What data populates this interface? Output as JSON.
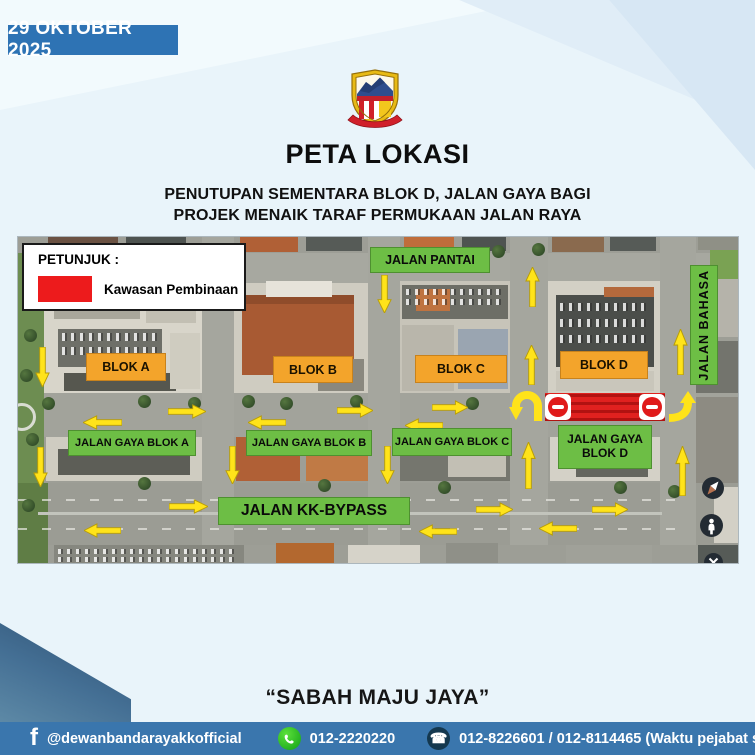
{
  "banner": {
    "date": "29 OKTOBER 2025",
    "bg": "#2e73b4"
  },
  "title": "PETA LOKASI",
  "subtitle": {
    "line1": "PENUTUPAN SEMENTARA BLOK D, JALAN GAYA BAGI",
    "line2": "PROJEK MENAIK TARAF PERMUKAAN JALAN RAYA"
  },
  "legend": {
    "heading": "PETUNJUK :",
    "label": "Kawasan Pembinaan",
    "swatch_color": "#ed1b1c"
  },
  "map": {
    "road_label_color": "#6dbe45",
    "block_label_color": "#f3a42b",
    "arrow_color": "#ffe31a",
    "construction_color": "#e0211f",
    "road_labels": [
      {
        "text": "JALAN PANTAI",
        "x": 352,
        "y": 10,
        "w": 120,
        "h": 26,
        "fs": 12.5
      },
      {
        "text": "JALAN BAHASA",
        "x": 672,
        "y": 28,
        "w": 28,
        "h": 120,
        "fs": 12.5,
        "vertical": true
      },
      {
        "text": "JALAN GAYA BLOK A",
        "x": 50,
        "y": 193,
        "w": 128,
        "h": 26,
        "fs": 11
      },
      {
        "text": "JALAN GAYA BLOK B",
        "x": 228,
        "y": 193,
        "w": 126,
        "h": 26,
        "fs": 11
      },
      {
        "text": "JALAN GAYA BLOK C",
        "x": 374,
        "y": 191,
        "w": 120,
        "h": 28,
        "fs": 11
      },
      {
        "text": "JALAN GAYA BLOK D",
        "x": 540,
        "y": 188,
        "w": 94,
        "h": 44,
        "fs": 12
      },
      {
        "text": "JALAN KK-BYPASS",
        "x": 200,
        "y": 260,
        "w": 192,
        "h": 28,
        "fs": 15.5
      }
    ],
    "block_labels": [
      {
        "text": "BLOK A",
        "x": 68,
        "y": 116,
        "w": 80,
        "h": 28
      },
      {
        "text": "BLOK B",
        "x": 255,
        "y": 119,
        "w": 80,
        "h": 27
      },
      {
        "text": "BLOK C",
        "x": 397,
        "y": 118,
        "w": 92,
        "h": 28
      },
      {
        "text": "BLOK D",
        "x": 542,
        "y": 114,
        "w": 88,
        "h": 28
      }
    ],
    "construction_zone": {
      "x": 527,
      "y": 156,
      "w": 120,
      "h": 28
    },
    "no_entry_signs": [
      {
        "x": 527,
        "y": 157
      },
      {
        "x": 621,
        "y": 157
      }
    ],
    "arrows": [
      {
        "dir": "down",
        "x": 17,
        "y": 110,
        "l": 40
      },
      {
        "dir": "down",
        "x": 359,
        "y": 38,
        "l": 38
      },
      {
        "dir": "up",
        "x": 507,
        "y": 30,
        "l": 40
      },
      {
        "dir": "up",
        "x": 506,
        "y": 108,
        "l": 40
      },
      {
        "dir": "up",
        "x": 655,
        "y": 92,
        "l": 46
      },
      {
        "dir": "right",
        "x": 150,
        "y": 167,
        "l": 38
      },
      {
        "dir": "left",
        "x": 65,
        "y": 178,
        "l": 39
      },
      {
        "dir": "left",
        "x": 230,
        "y": 178,
        "l": 38
      },
      {
        "dir": "right",
        "x": 319,
        "y": 166,
        "l": 36
      },
      {
        "dir": "right",
        "x": 414,
        "y": 163,
        "l": 36
      },
      {
        "dir": "left",
        "x": 387,
        "y": 181,
        "l": 38
      },
      {
        "dir": "down",
        "x": 207,
        "y": 209,
        "l": 38
      },
      {
        "dir": "down",
        "x": 362,
        "y": 209,
        "l": 38
      },
      {
        "dir": "up",
        "x": 503,
        "y": 205,
        "l": 47
      },
      {
        "dir": "up",
        "x": 657,
        "y": 209,
        "l": 50
      },
      {
        "dir": "down",
        "x": 15,
        "y": 210,
        "l": 40
      },
      {
        "dir": "right",
        "x": 151,
        "y": 262,
        "l": 39
      },
      {
        "dir": "left",
        "x": 66,
        "y": 286,
        "l": 37
      },
      {
        "dir": "right",
        "x": 458,
        "y": 265,
        "l": 37
      },
      {
        "dir": "right",
        "x": 574,
        "y": 265,
        "l": 36
      },
      {
        "dir": "left",
        "x": 521,
        "y": 284,
        "l": 38
      },
      {
        "dir": "left",
        "x": 401,
        "y": 287,
        "l": 38
      }
    ],
    "curved_arrows": [
      {
        "type": "uturn-down",
        "x": 490,
        "y": 153
      },
      {
        "type": "turn-up",
        "x": 649,
        "y": 153
      }
    ]
  },
  "slogan": "“SABAH MAJU JAYA”",
  "footer": {
    "bg": "#3a76ad",
    "facebook": "@dewanbandarayakkofficial",
    "whatsapp": "012-2220220",
    "phone": "012-8226601 / 012-8114465 (Waktu pejabat sahaja)"
  }
}
